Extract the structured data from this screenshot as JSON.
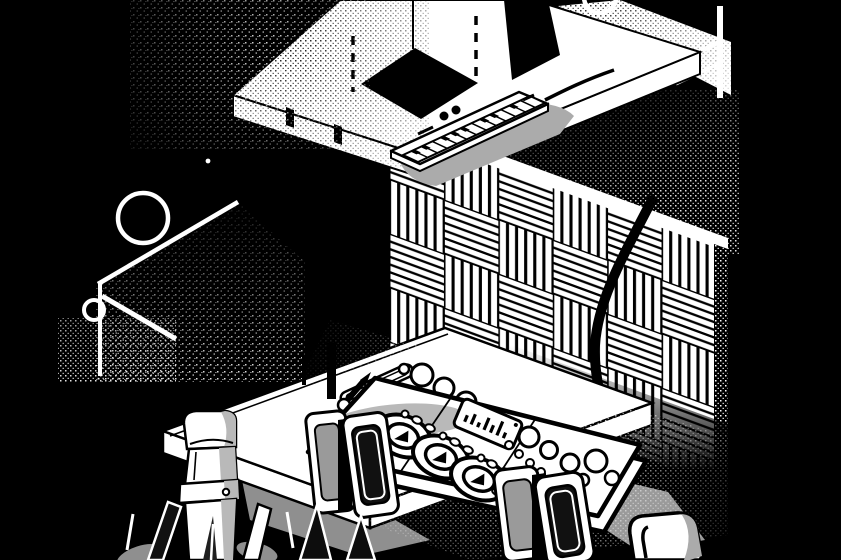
{
  "meta": {
    "title": "Isometric music studio illustration",
    "style": "black-and-white stipple dither illustration"
  },
  "palette": {
    "background": "#000000",
    "ink": "#000000",
    "paper": "#ffffff",
    "shadow_gray": "#ababab",
    "mid_gray": "#9a9a9a",
    "panel_gray": "#b9b9b9",
    "dark_gray": "#1f1f1f"
  },
  "scene": {
    "description": "Black and white isometric illustration of a music production studio: a floating platform with a square cutout holds a small MIDI keyboard; a thick cable runs down across a wall of checkerboard acoustic foam panels to a DJ mixer sitting on a desk between two studio monitors; a large microphone in a shock mount stands in front of the desk; outlined tables with rings float at the left and top right; a chair back appears at the lower right.",
    "objects": [
      {
        "name": "floating-platform",
        "label": "Floating platform with square cutout"
      },
      {
        "name": "midi-keyboard",
        "label": "MIDI keyboard"
      },
      {
        "name": "audio-cable",
        "label": "Audio cable"
      },
      {
        "name": "acoustic-foam-wall",
        "label": "Acoustic foam panel wall"
      },
      {
        "name": "left-table",
        "label": "Outlined table with ring, left"
      },
      {
        "name": "right-table",
        "label": "Outlined table with ring, top right"
      },
      {
        "name": "studio-desk",
        "label": "Studio desk"
      },
      {
        "name": "dj-mixer",
        "label": "DJ mixer / controller"
      },
      {
        "name": "monitor-left",
        "label": "Studio monitor, left"
      },
      {
        "name": "monitor-right",
        "label": "Studio monitor, right"
      },
      {
        "name": "microphone",
        "label": "Condenser microphone"
      },
      {
        "name": "mic-shock-mount",
        "label": "Microphone shock mount"
      },
      {
        "name": "chair",
        "label": "Chair back"
      }
    ]
  }
}
